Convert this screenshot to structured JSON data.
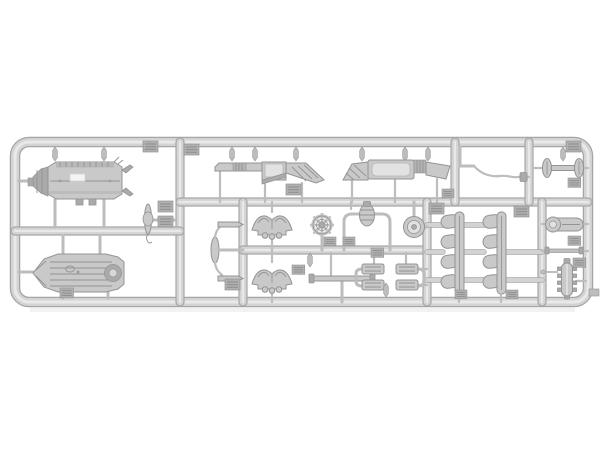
{
  "scene": {
    "description": "Photograph of a light grey injection-moulded plastic model-kit sprue (runner frame) holding many small unpainted vehicle parts on a white background",
    "background": "#ffffff"
  },
  "colors": {
    "background": "#ffffff",
    "rail_edge": "#a6a6a6",
    "rail_base": "#d3d3d3",
    "rail_hi": "#e9e9e9",
    "part": "#c9c9c9",
    "part_light": "#e2e2e2",
    "part_dark": "#aaaaaa",
    "outline": "#949494",
    "gate": "#bdbdbd",
    "tag": "#b0b0b0",
    "tag_ridge": "#8d8d8d",
    "white_patch": "#f4f4f4"
  },
  "sprue": {
    "material": "light grey styrene",
    "molding_tag_count": 20,
    "parts": [
      {
        "id": "tank-top",
        "label": "large cylindrical tank / hull part with hatches and feet"
      },
      {
        "id": "tank-bottom",
        "label": "ribbed boat-shaped hull part with round end cap"
      },
      {
        "id": "fender-left",
        "label": "flat fender with ribbed block and hatched sloped end"
      },
      {
        "id": "fender-right",
        "label": "flat fender with open frame and sloped ends"
      },
      {
        "id": "bent-rod",
        "label": "bent tow-bar rod with elbow fitting"
      },
      {
        "id": "clamp-ovals",
        "label": "bar linking two oval pads"
      },
      {
        "id": "spindle",
        "label": "small spindle shaft with hook"
      },
      {
        "id": "link-arms",
        "label": "central spindle linked to two pin arms by curved rods"
      },
      {
        "id": "bracket-upper",
        "label": "winged mounting bracket"
      },
      {
        "id": "bracket-lower",
        "label": "winged mounting bracket"
      },
      {
        "id": "handwheel",
        "label": "spoked hand wheel on stem"
      },
      {
        "id": "pipe-arch",
        "label": "pipe arch with finned pump body"
      },
      {
        "id": "pulley",
        "label": "round pulley wheel"
      },
      {
        "id": "flat-bar",
        "label": "flat cross bar with end caps"
      },
      {
        "id": "pump-blocks-left",
        "label": "pair of ribbed blocks with elbow pipe"
      },
      {
        "id": "pump-blocks-right",
        "label": "pair of ribbed blocks with elbow pipe"
      },
      {
        "id": "manifold-left",
        "label": "four-port exhaust manifold"
      },
      {
        "id": "manifold-right",
        "label": "four-port exhaust manifold"
      },
      {
        "id": "end-cylinder",
        "label": "cylinder with round end cap"
      },
      {
        "id": "thin-rod",
        "label": "thin axle rod"
      },
      {
        "id": "ribbed-grenade",
        "label": "small ribbed cylindrical body with side lugs"
      }
    ]
  }
}
